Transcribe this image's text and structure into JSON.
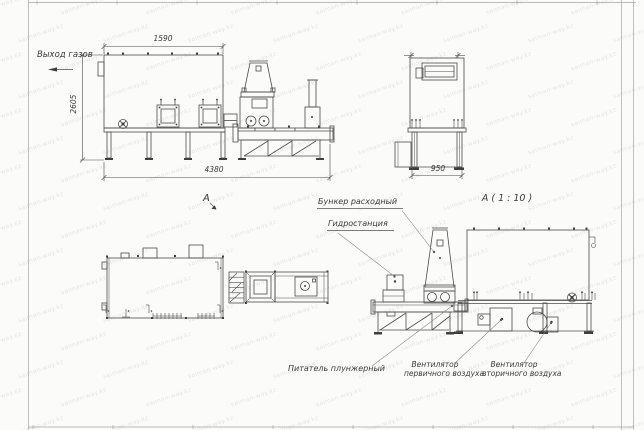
{
  "page": {
    "background": "#fbfbfa",
    "watermark": {
      "text": "saiman-way.kz"
    }
  },
  "colors": {
    "drawing_line": "#4c4c4c",
    "sheet_frame": "#a6a6a6",
    "label_text": "#3a3a3a",
    "watermark_text": "#dededf"
  },
  "labels": {
    "gas_outlet": "Выход газов",
    "view_a_marker": "A",
    "view_a_scaled": "А ( 1 : 10 )",
    "hopper": "Бункер расходный",
    "hydraulic_station": "Гидростанция",
    "plunger_feeder": "Питатель плунжерный",
    "primary_fan_line1": "Вентилятор",
    "primary_fan_line2": "первичного воздуха",
    "secondary_fan_line1": "Вентилятор",
    "secondary_fan_line2": "вторичного воздуха"
  },
  "dimensions": {
    "furnace_width": "1590",
    "furnace_height": "2605",
    "total_length": "4380",
    "end_view_width": "950"
  }
}
